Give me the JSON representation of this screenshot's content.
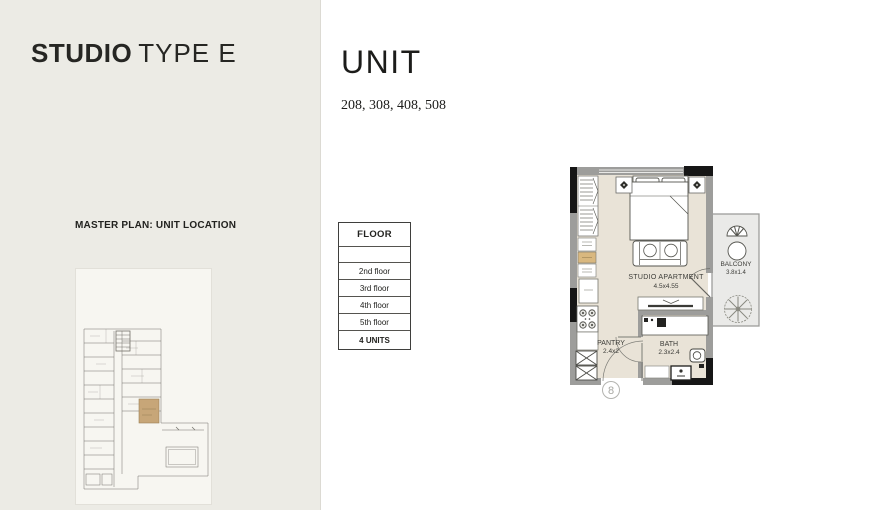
{
  "sidebar": {
    "title_bold": "STUDIO",
    "title_light": "TYPE E",
    "master_plan_label": "MASTER PLAN: UNIT LOCATION"
  },
  "main": {
    "unit_title": "UNIT",
    "unit_numbers": "208, 308, 408, 508"
  },
  "floor_table": {
    "header": "FLOOR",
    "rows": [
      "2nd floor",
      "3rd floor",
      "4th floor",
      "5th floor"
    ],
    "footer": "4 UNITS"
  },
  "floor_plan": {
    "rooms": [
      {
        "name": "STUDIO APARTMENT",
        "dimensions": "4.5x4.55"
      },
      {
        "name": "BALCONY",
        "dimensions": "3.8x1.4"
      },
      {
        "name": "PANTRY",
        "dimensions": "2.4x2"
      },
      {
        "name": "BATH",
        "dimensions": "2.3x2.4"
      }
    ],
    "entry_number": "8"
  },
  "colors": {
    "sidebar_bg": "#ecebe5",
    "floor_fill": "#e9e3d7",
    "balcony_fill": "#eaeae8",
    "wall_gray": "#9d9d9b",
    "wall_black": "#161616",
    "unit_highlight": "#c7a678",
    "text": "#232320"
  }
}
